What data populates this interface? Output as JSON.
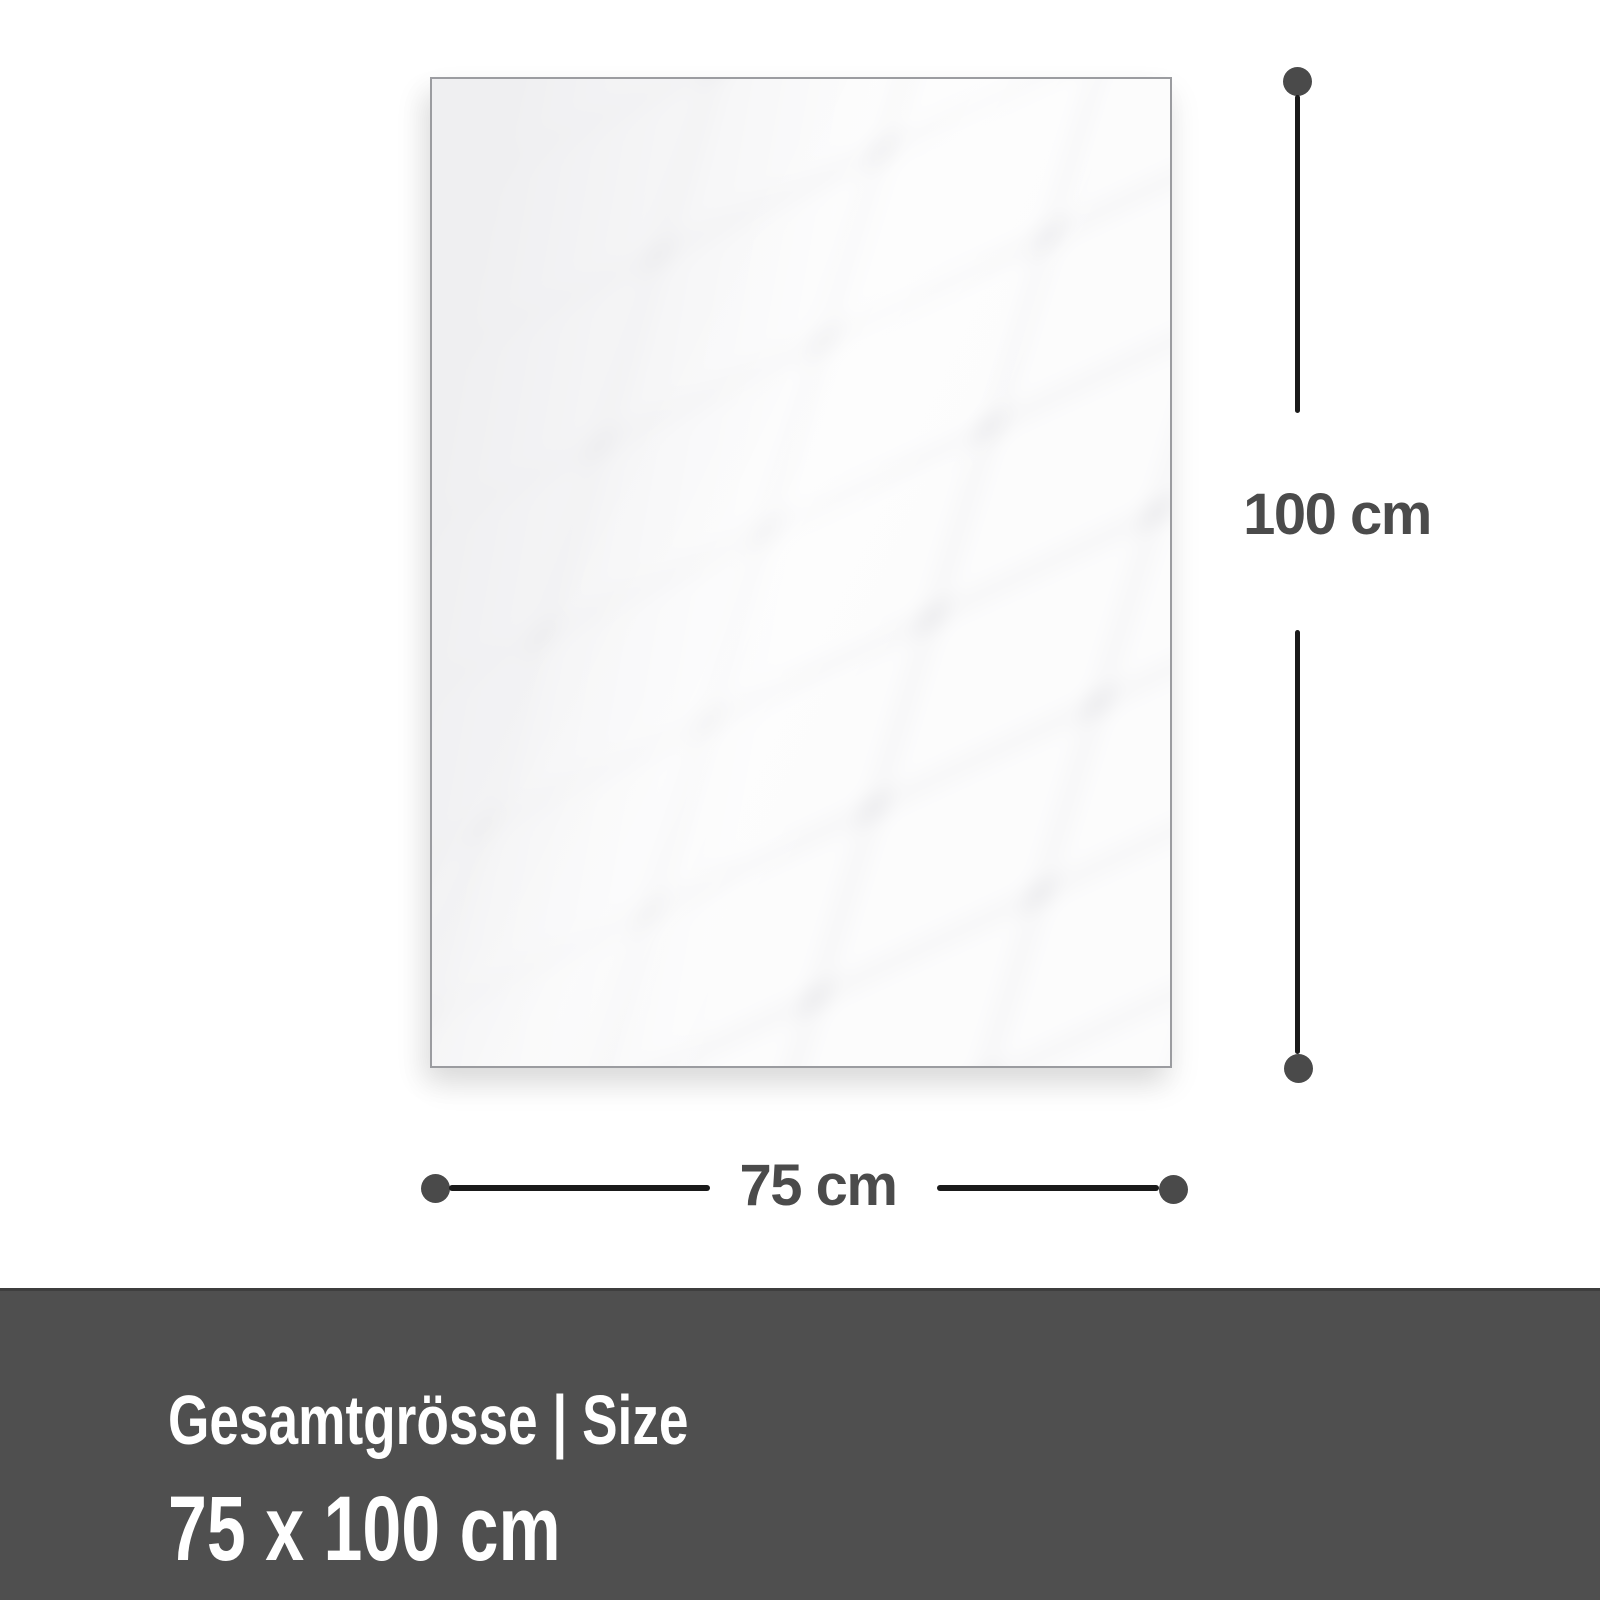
{
  "product_diagram": {
    "dimensions": {
      "height": {
        "label": "100 cm"
      },
      "width": {
        "label": "75 cm"
      }
    },
    "footer": {
      "title": "Gesamtgrösse | Size",
      "size": "75 x 100 cm"
    }
  },
  "colors": {
    "page_bg": "#ffffff",
    "panel_fill": "#efeff1",
    "panel_border": "#9b9ca0",
    "dimension_line": "#1a1a1a",
    "dimension_dot": "#4a4a4a",
    "dimension_text": "#4b4b4b",
    "banner_bg": "#4f4f4f",
    "banner_top_edge": "#3e3e3e",
    "banner_text": "#ffffff"
  }
}
